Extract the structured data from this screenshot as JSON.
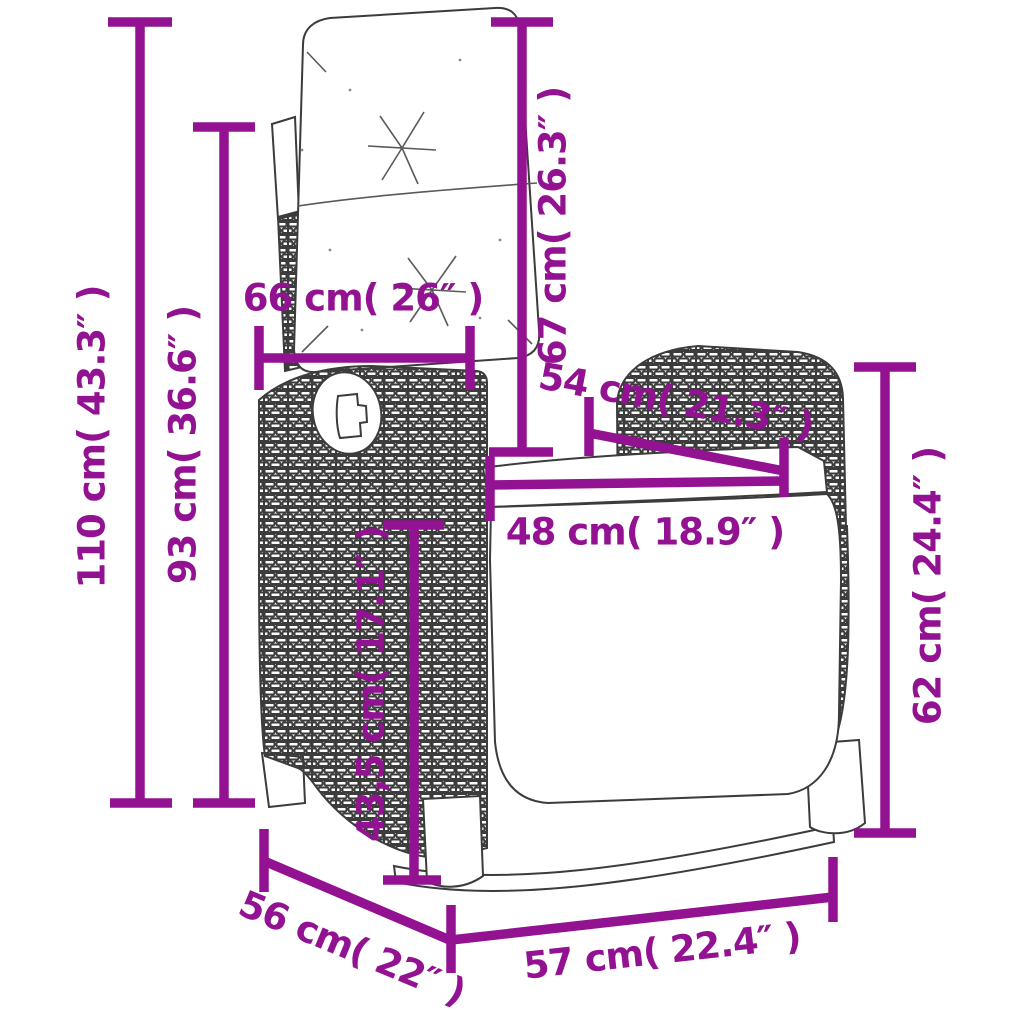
{
  "diagram": {
    "dimension_color": "#921292",
    "dimensions": {
      "overall_height": {
        "label": "110 cm( 43.3″ )"
      },
      "backrest_top_height": {
        "label": "93 cm( 36.6″ )"
      },
      "backrest_cushion_width": {
        "label": "66 cm( 26″ )"
      },
      "backrest_cushion_height": {
        "label": "67 cm( 26.3″ )"
      },
      "seat_back_width": {
        "label": "54 cm( 21.3″ )"
      },
      "seat_front_width": {
        "label": "48 cm( 18.9″ )"
      },
      "seat_height": {
        "label": "43,5 cm( 17.1″ )"
      },
      "armrest_height": {
        "label": "62 cm( 24.4″ )"
      },
      "seat_depth": {
        "label": "56 cm( 22″ )"
      },
      "overall_width": {
        "label": "57 cm( 22.4″ )"
      }
    }
  }
}
